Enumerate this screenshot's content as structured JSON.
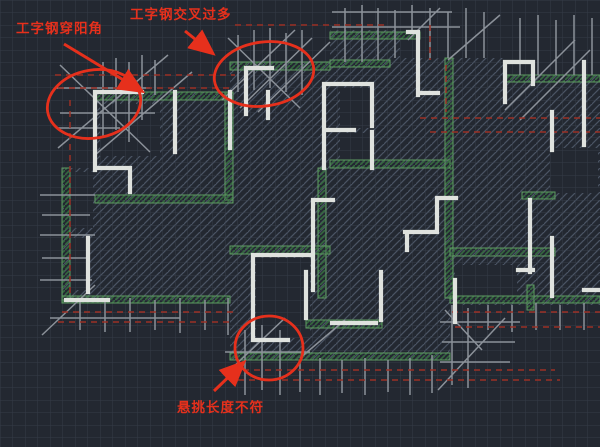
{
  "canvas": {
    "type": "cad-drawing-viewport",
    "description": "dark CAD floor plan with scaffolding I-beam layout and red review markups",
    "width": 600,
    "height": 447
  },
  "colors": {
    "background": "#232831",
    "grid_line": "#39414f",
    "hatch_line": "#4a5464",
    "wall_white": "#dfe2de",
    "beam_green": "#5f9c63",
    "beam_green_dark": "#35693f",
    "scaffold_gray": "#8b9199",
    "tie_red_dashed": "#9b3026",
    "annotation_red": "#e6301c"
  },
  "annotations": {
    "color": "#e6301c",
    "items": [
      {
        "id": "note-ibeam-through-corner",
        "label": "工字钢穿阳角"
      },
      {
        "id": "note-ibeam-too-many-cross",
        "label": "工字钢交叉过多"
      },
      {
        "id": "note-cantilever-length",
        "label": "悬挑长度不符"
      }
    ]
  }
}
